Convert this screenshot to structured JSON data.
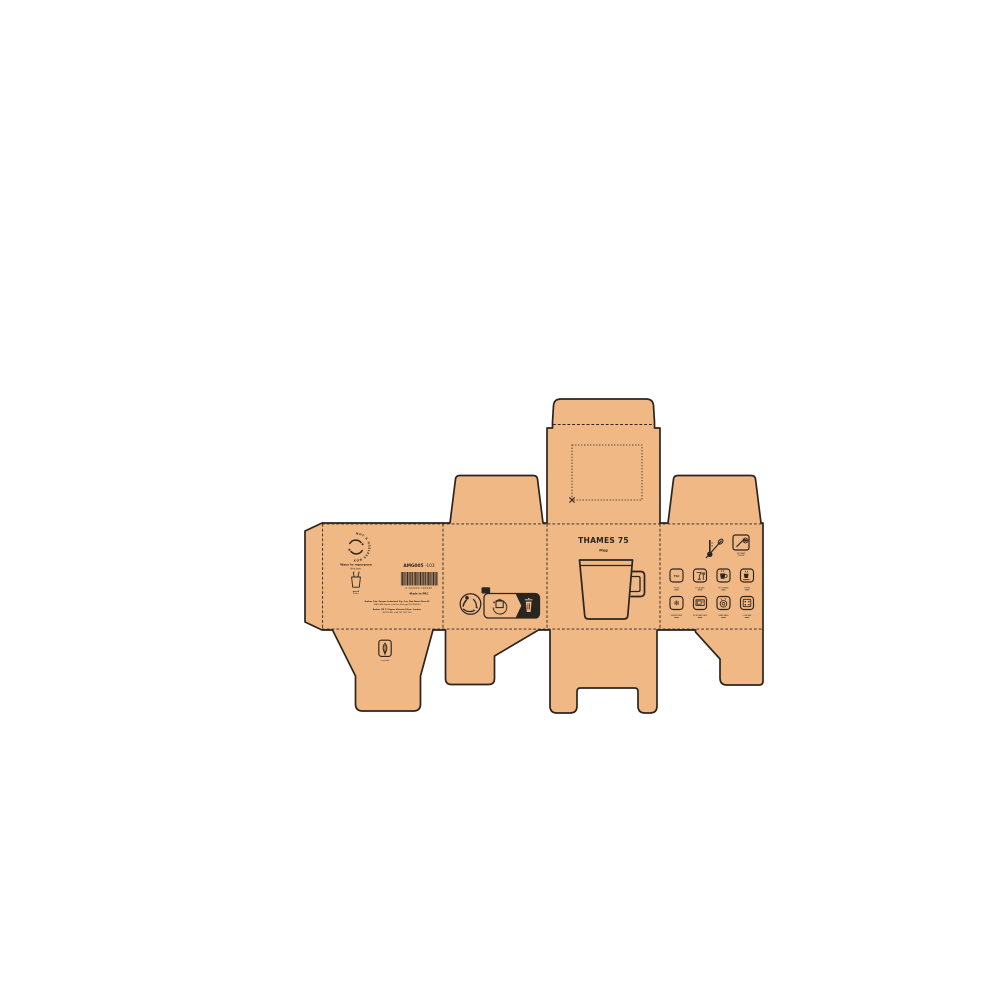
{
  "artwork": {
    "cardboard_color": "#F0B884",
    "line_color": "#2B2520"
  },
  "front_panel": {
    "title": "THAMES 75",
    "subtitle": "Mug"
  },
  "back_panel": {
    "badge_text": "NOT A USELESS BOX",
    "repurpose_line1": "Ways to repurpose",
    "repurpose_line2": "this box:",
    "pencil_caption1": "pencil",
    "pencil_caption2": "holder",
    "sku_bold": "AMG005",
    "sku_suffix": "-103",
    "barcode_digits": "0 000000 000000",
    "made_in": "Made in PRC",
    "address_line1": "Amber, Lda. Parque Industrial Fig. Foz, Rua Nova Obra 44",
    "address_line2": "3080-380 Figueira da Foz, Portugal 910506090",
    "address_line3": "Amber UK 71 Upper Victoria Place, London",
    "address_line4": "WC2N 5BL +44 101 209 100",
    "leaf_caption": "recyclable"
  },
  "recycling_panel": {
    "infotri_tab_label": "FR"
  },
  "care_panel": {
    "capacity_label": "75cl",
    "snowflake_glyph": "❄",
    "decorate_caption1": "DECORATE",
    "decorate_caption2": "& REUSE",
    "icons": [
      {
        "name": "capacity-icon",
        "caption": "750 ML"
      },
      {
        "name": "food-safe-icon",
        "caption": "FOOD SAFE"
      },
      {
        "name": "hot-drink-icon",
        "caption": "HOT DRINKS"
      },
      {
        "name": "coffee-icon",
        "caption": "COFFEE"
      },
      {
        "name": "freezer-icon",
        "caption": "FREEZER SAFE"
      },
      {
        "name": "microwave-icon",
        "caption": "MICROWAVE SAFE"
      },
      {
        "name": "dishwasher-icon",
        "caption": "HAND WASH"
      },
      {
        "name": "oven-icon",
        "caption": "OVEN SAFE"
      }
    ]
  }
}
